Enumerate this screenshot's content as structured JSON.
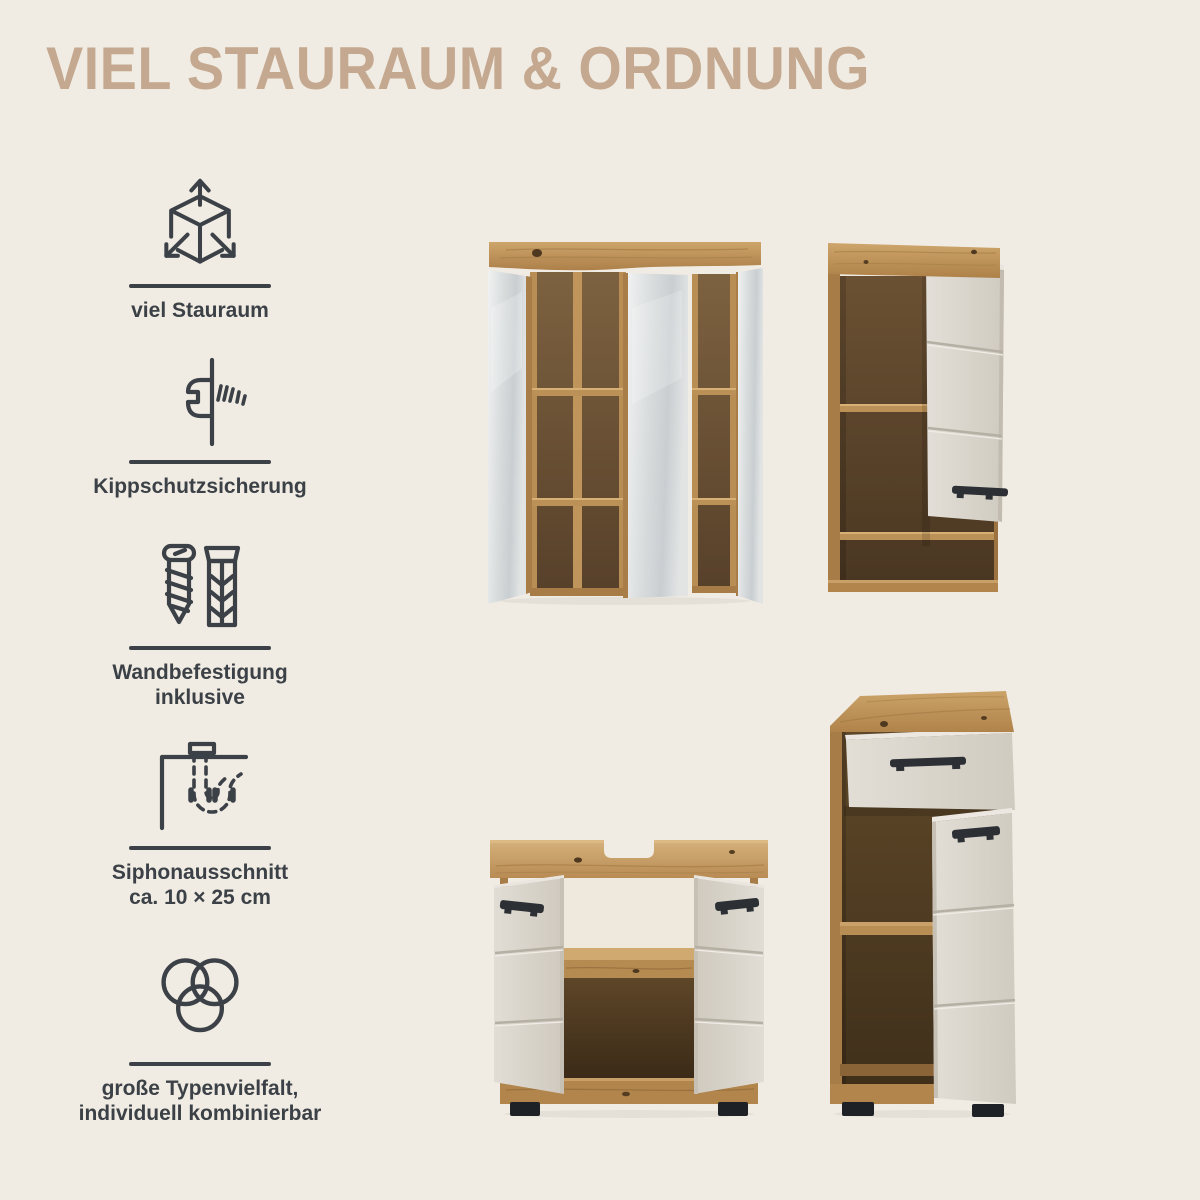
{
  "header": {
    "title": "VIEL STAURAUM & ORDNUNG"
  },
  "features": [
    {
      "icon": "cube-arrows-icon",
      "label": "viel Stauraum"
    },
    {
      "icon": "wall-screw-icon",
      "label": "Kippschutzsicherung"
    },
    {
      "icon": "screw-dowel-icon",
      "label": "Wandbefestigung\ninklusive"
    },
    {
      "icon": "siphon-icon",
      "label": "Siphonausschnitt\nca. 10 × 25 cm"
    },
    {
      "icon": "overlapping-circles-icon",
      "label": "große Typenvielfalt,\nindividuell kombinierbar"
    }
  ],
  "illustrations": [
    {
      "name": "mirror-cabinet-with-open-mirror-doors"
    },
    {
      "name": "wall-cabinet-with-open-door"
    },
    {
      "name": "sink-vanity-cabinet-with-open-doors"
    },
    {
      "name": "tall-cabinet-with-open-drawer-and-door"
    }
  ],
  "colors": {
    "background": "#f1ece3",
    "title": "#c4a88f",
    "ink": "#3b4147",
    "wood_light": "#cda56b",
    "wood": "#b1854b",
    "wood_interior_dark": "#5a422a",
    "door_grey": "#d8d3ca",
    "mirror_grey": "#d6dadb",
    "handle_black": "#2c2f34",
    "feet_black": "#1e2125"
  }
}
